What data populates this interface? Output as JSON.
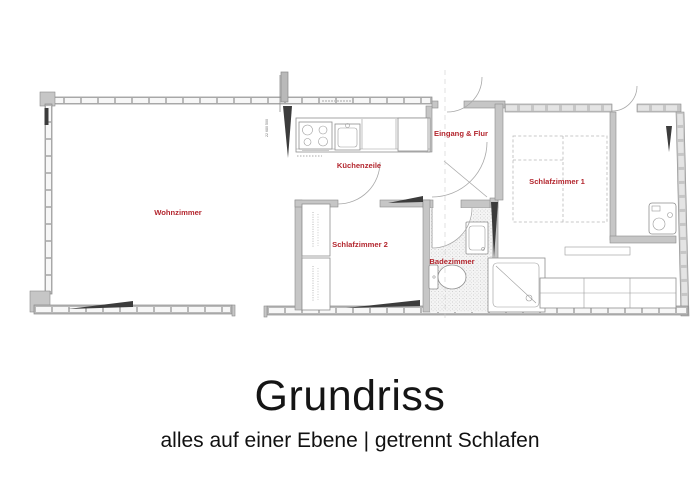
{
  "plan": {
    "rooms": [
      {
        "id": "wohnzimmer",
        "label": "Wohnzimmer"
      },
      {
        "id": "kuechenzeile",
        "label": "Küchenzeile"
      },
      {
        "id": "eingang_flur",
        "label": "Eingang & Flur"
      },
      {
        "id": "schlafzimmer1",
        "label": "Schlafzimmer 1"
      },
      {
        "id": "schlafzimmer2",
        "label": "Schlafzimmer 2"
      },
      {
        "id": "badezimmer",
        "label": "Badezimmer"
      }
    ],
    "annotations": {
      "dimension_note": "22 680 500"
    },
    "icons": [
      "stove-icon",
      "sink-icon",
      "fridge-icon",
      "toilet-icon",
      "washbasin-icon",
      "shower-icon",
      "washing-machine-icon",
      "bed-outline",
      "wardrobe",
      "door-arc",
      "window-marker-icon"
    ]
  },
  "caption": {
    "title": "Grundriss",
    "subtitle": "alles auf einer Ebene | getrennt Schlafen"
  },
  "colors": {
    "label_red": "#b3262e",
    "title_black": "#151515",
    "wall_gray": "#c6c6c6",
    "window_wall_gray": "#b9b9b9",
    "dark_marker": "#3c3c3c",
    "background": "#ffffff"
  }
}
